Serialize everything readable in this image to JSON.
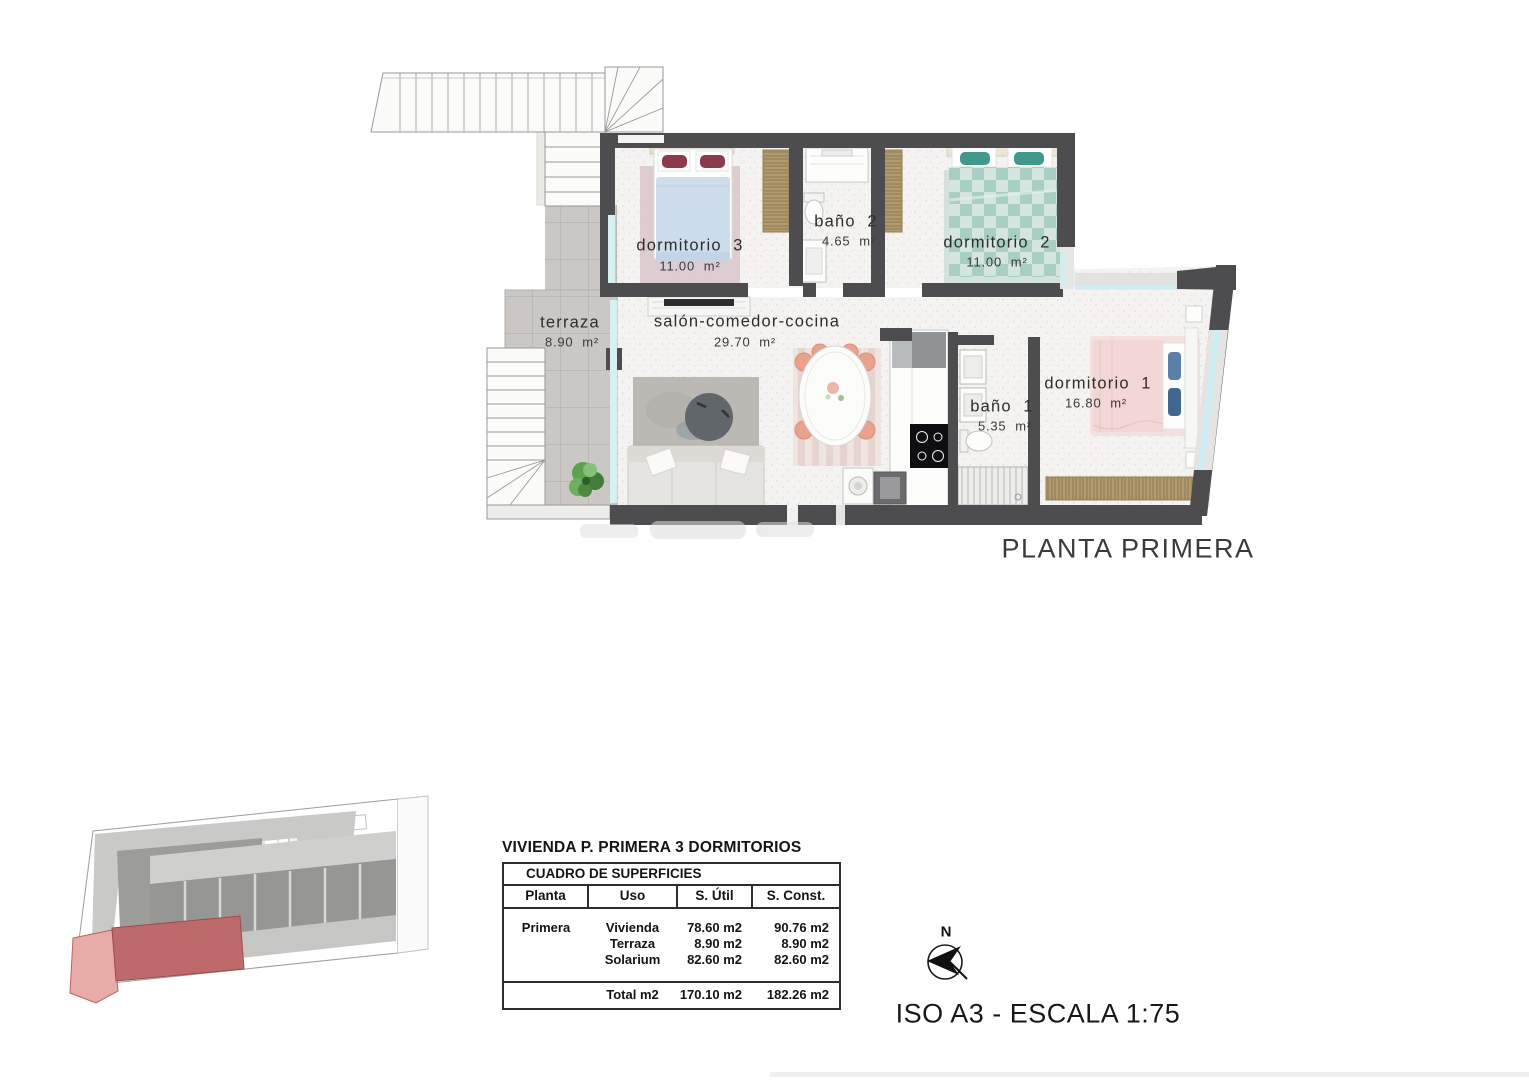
{
  "plan": {
    "title": "PLANTA PRIMERA",
    "scale_note": "ISO A3 - ESCALA 1:75",
    "compass_label": "N",
    "rooms": [
      {
        "name": "dormitorio  3",
        "area": "11.00  m²"
      },
      {
        "name": "baño  2",
        "area": "4.65  m²"
      },
      {
        "name": "dormitorio  2",
        "area": "11.00  m²"
      },
      {
        "name": "terraza",
        "area": "8.90  m²"
      },
      {
        "name": "salón-comedor-cocina",
        "area": "29.70  m²"
      },
      {
        "name": "baño  1",
        "area": "5.35  m²"
      },
      {
        "name": "dormitorio  1",
        "area": "16.80  m²"
      }
    ]
  },
  "surfaces_table": {
    "title": "VIVIENDA P. PRIMERA 3 DORMITORIOS",
    "band_header": "CUADRO DE SUPERFICIES",
    "columns": [
      "Planta",
      "Uso",
      "S. Útil",
      "S. Const."
    ],
    "rows": [
      {
        "planta": "Primera",
        "uso": "Vivienda",
        "s_util": "78.60 m2",
        "s_const": "90.76 m2"
      },
      {
        "planta": "",
        "uso": "Terraza",
        "s_util": "8.90 m2",
        "s_const": "8.90 m2"
      },
      {
        "planta": "",
        "uso": "Solarium",
        "s_util": "82.60 m2",
        "s_const": "82.60 m2"
      }
    ],
    "total_row": {
      "label": "Total m2",
      "s_util": "170.10 m2",
      "s_const": "182.26 m2"
    }
  },
  "colors": {
    "wall": "#4d4d4f",
    "window_glass": "#cdeef2",
    "terrace_tile": "#cac7c5",
    "highlight_unit": "#bf6a6a"
  }
}
